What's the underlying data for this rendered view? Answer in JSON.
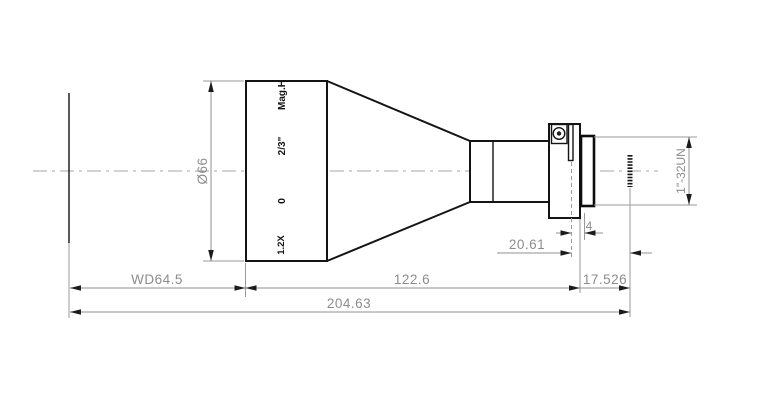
{
  "drawing": {
    "type": "telecentric-lens-outline-drawing",
    "units": "mm",
    "dimensions": {
      "front_diameter": "Ø66",
      "working_distance": "WD64.5",
      "barrel_length": "122.6",
      "rear_section": "20.61",
      "flange_offset": "4",
      "flange_focal_distance": "17.526",
      "total_length": "204.63",
      "mount_thread": "1\"-32UN"
    },
    "barrel_markings": {
      "brand": "Mag.H",
      "sensor_format": "2/3\"",
      "focus_index": "0",
      "magnification": "1.2X"
    },
    "colors": {
      "outline": "#141414",
      "dimension": "#909090",
      "background": "#ffffff"
    }
  }
}
